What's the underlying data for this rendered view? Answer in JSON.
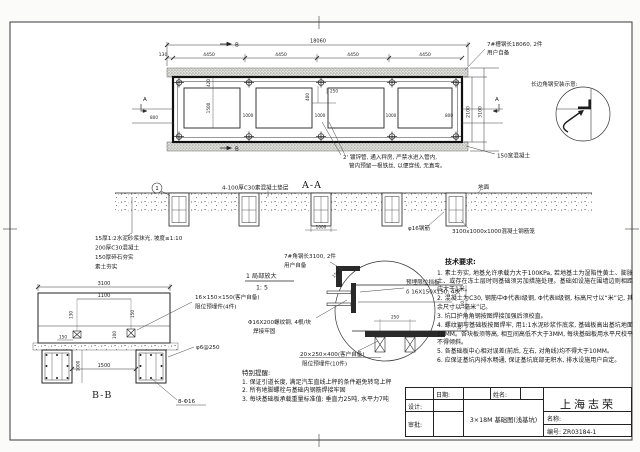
{
  "plan": {
    "dim_total": "18060",
    "dim_segments": [
      "130",
      "4450",
      "4450",
      "4450",
      "4450"
    ],
    "dim_inner_h": "2100",
    "dim_outer_h": "3100",
    "dim_opening_h": "1500",
    "dim_opening_top": "420",
    "dim_gap": "1000",
    "dim_edge_left": "800",
    "dim_edge_right": "800",
    "dim_conduit_x": "250",
    "dim_conduit_y": "400",
    "marker_a": "A",
    "marker_b": "B",
    "note_channel_1": "7#槽钢长18060, 2件",
    "note_channel_2": "用户自备",
    "note_concrete": "150宽混凝土",
    "note_pipe_1": "2' 镀锌管, 通入秤房, 严禁水进入管内,",
    "note_pipe_2": "管内预留一根铁丝, 以便穿线, 无直弯。"
  },
  "corner_detail": {
    "title": "长边角钢安装示意:"
  },
  "section_aa": {
    "label": "A-A",
    "ground": "地面",
    "cushion_note": "4-100厚C30素混凝土垫层",
    "layers": [
      "15厚1:2水泥砂浆抹光, 坡度≤1:10",
      "200厚C30混凝土",
      "150厚碎石夯实",
      "素土夯实"
    ],
    "rebar_note": "φ16钢筋",
    "cage_note": "3100x1000x1000混凝土钢筋笼",
    "dim_pit": "1000",
    "bubble": "1"
  },
  "section_bb": {
    "label": "B-B",
    "dim_3100": "3100",
    "dim_1100": "1100",
    "dim_130": "130",
    "dim_150": "150",
    "dim_100": "100",
    "dim_1000": "1000",
    "dim_1500": "1500",
    "plate_note_1": "16×150×150(客户自备)",
    "plate_note_2": "限位预埋件(4件)",
    "stirrup_note": "φ6@250",
    "rebar_note": "8-Φ16"
  },
  "detail1": {
    "title": "1 局部放大",
    "scale": "1: 5",
    "angle_note_1": "7#角钢长3100, 2件",
    "angle_note_2": "用户自备",
    "baffle_note_1": "预埋限位挡板",
    "baffle_note_2": "δ 16X150X150, 4块",
    "bolt_note_1": "Φ16X200螺纹钢, 4根/块",
    "bolt_note_2": "焊接牢固",
    "anchor_note_1": "20×250×400(客户自备)",
    "anchor_note_2": "限位预埋件(10件)",
    "dim_250": "250",
    "dim_110": "110",
    "dim_10": "10",
    "dim_150": "150"
  },
  "tech": {
    "title": "技术要求:",
    "items": [
      "1. 素土夯实, 地基允许承载力大于100KPa, 若地基土为湿陷性黄土、膨胀土、或存在冻土层时则基础须另加措施处理。基础如设施在围墙边则相距应大于1米。",
      "2. 混凝土为C30, 钢筋中Φ代表Ⅰ级钢, Φ代表Ⅱ级钢, 标高尺寸以“米”记, 其余尺寸以“毫米”记。",
      "3. 坑口护角角钢按图焊接加强后须校直。",
      "4. 螺纹钢与基础板按图焊牢, 用1:1水泥砂浆作底浆, 基础板高出基坑地面10MM。各块板须等高, 相互间高低不大于3MM, 每块基础板用水平尺校平不得倾斜。",
      "5. 各基础板中心相对误差(前后, 左右, 对角线)均不得大于10MM。",
      "6. 应保证基坑内排水畅通, 保证基坑底部无积水, 排水设施用户自定。"
    ]
  },
  "reminder": {
    "title": "特别提醒:",
    "items": [
      "1. 保证引道长度, 满足汽车直线上秤的条件避免转弯上秤",
      "2. 所有地脚螺栓与基础内钢筋焊接牢固",
      "3. 每块基础板承载重量标准值: 垂直力25吨, 水平力7吨"
    ]
  },
  "titleblock": {
    "date_label": "日期:",
    "name_label": "姓名:",
    "design_label": "设计:",
    "approve_label": "审批:",
    "company": "上海志荣",
    "drawing_name_label": "名称:",
    "drawing_title": "3×18M 基础图(浅基坑)",
    "number": "编号: ZR03184-1"
  }
}
